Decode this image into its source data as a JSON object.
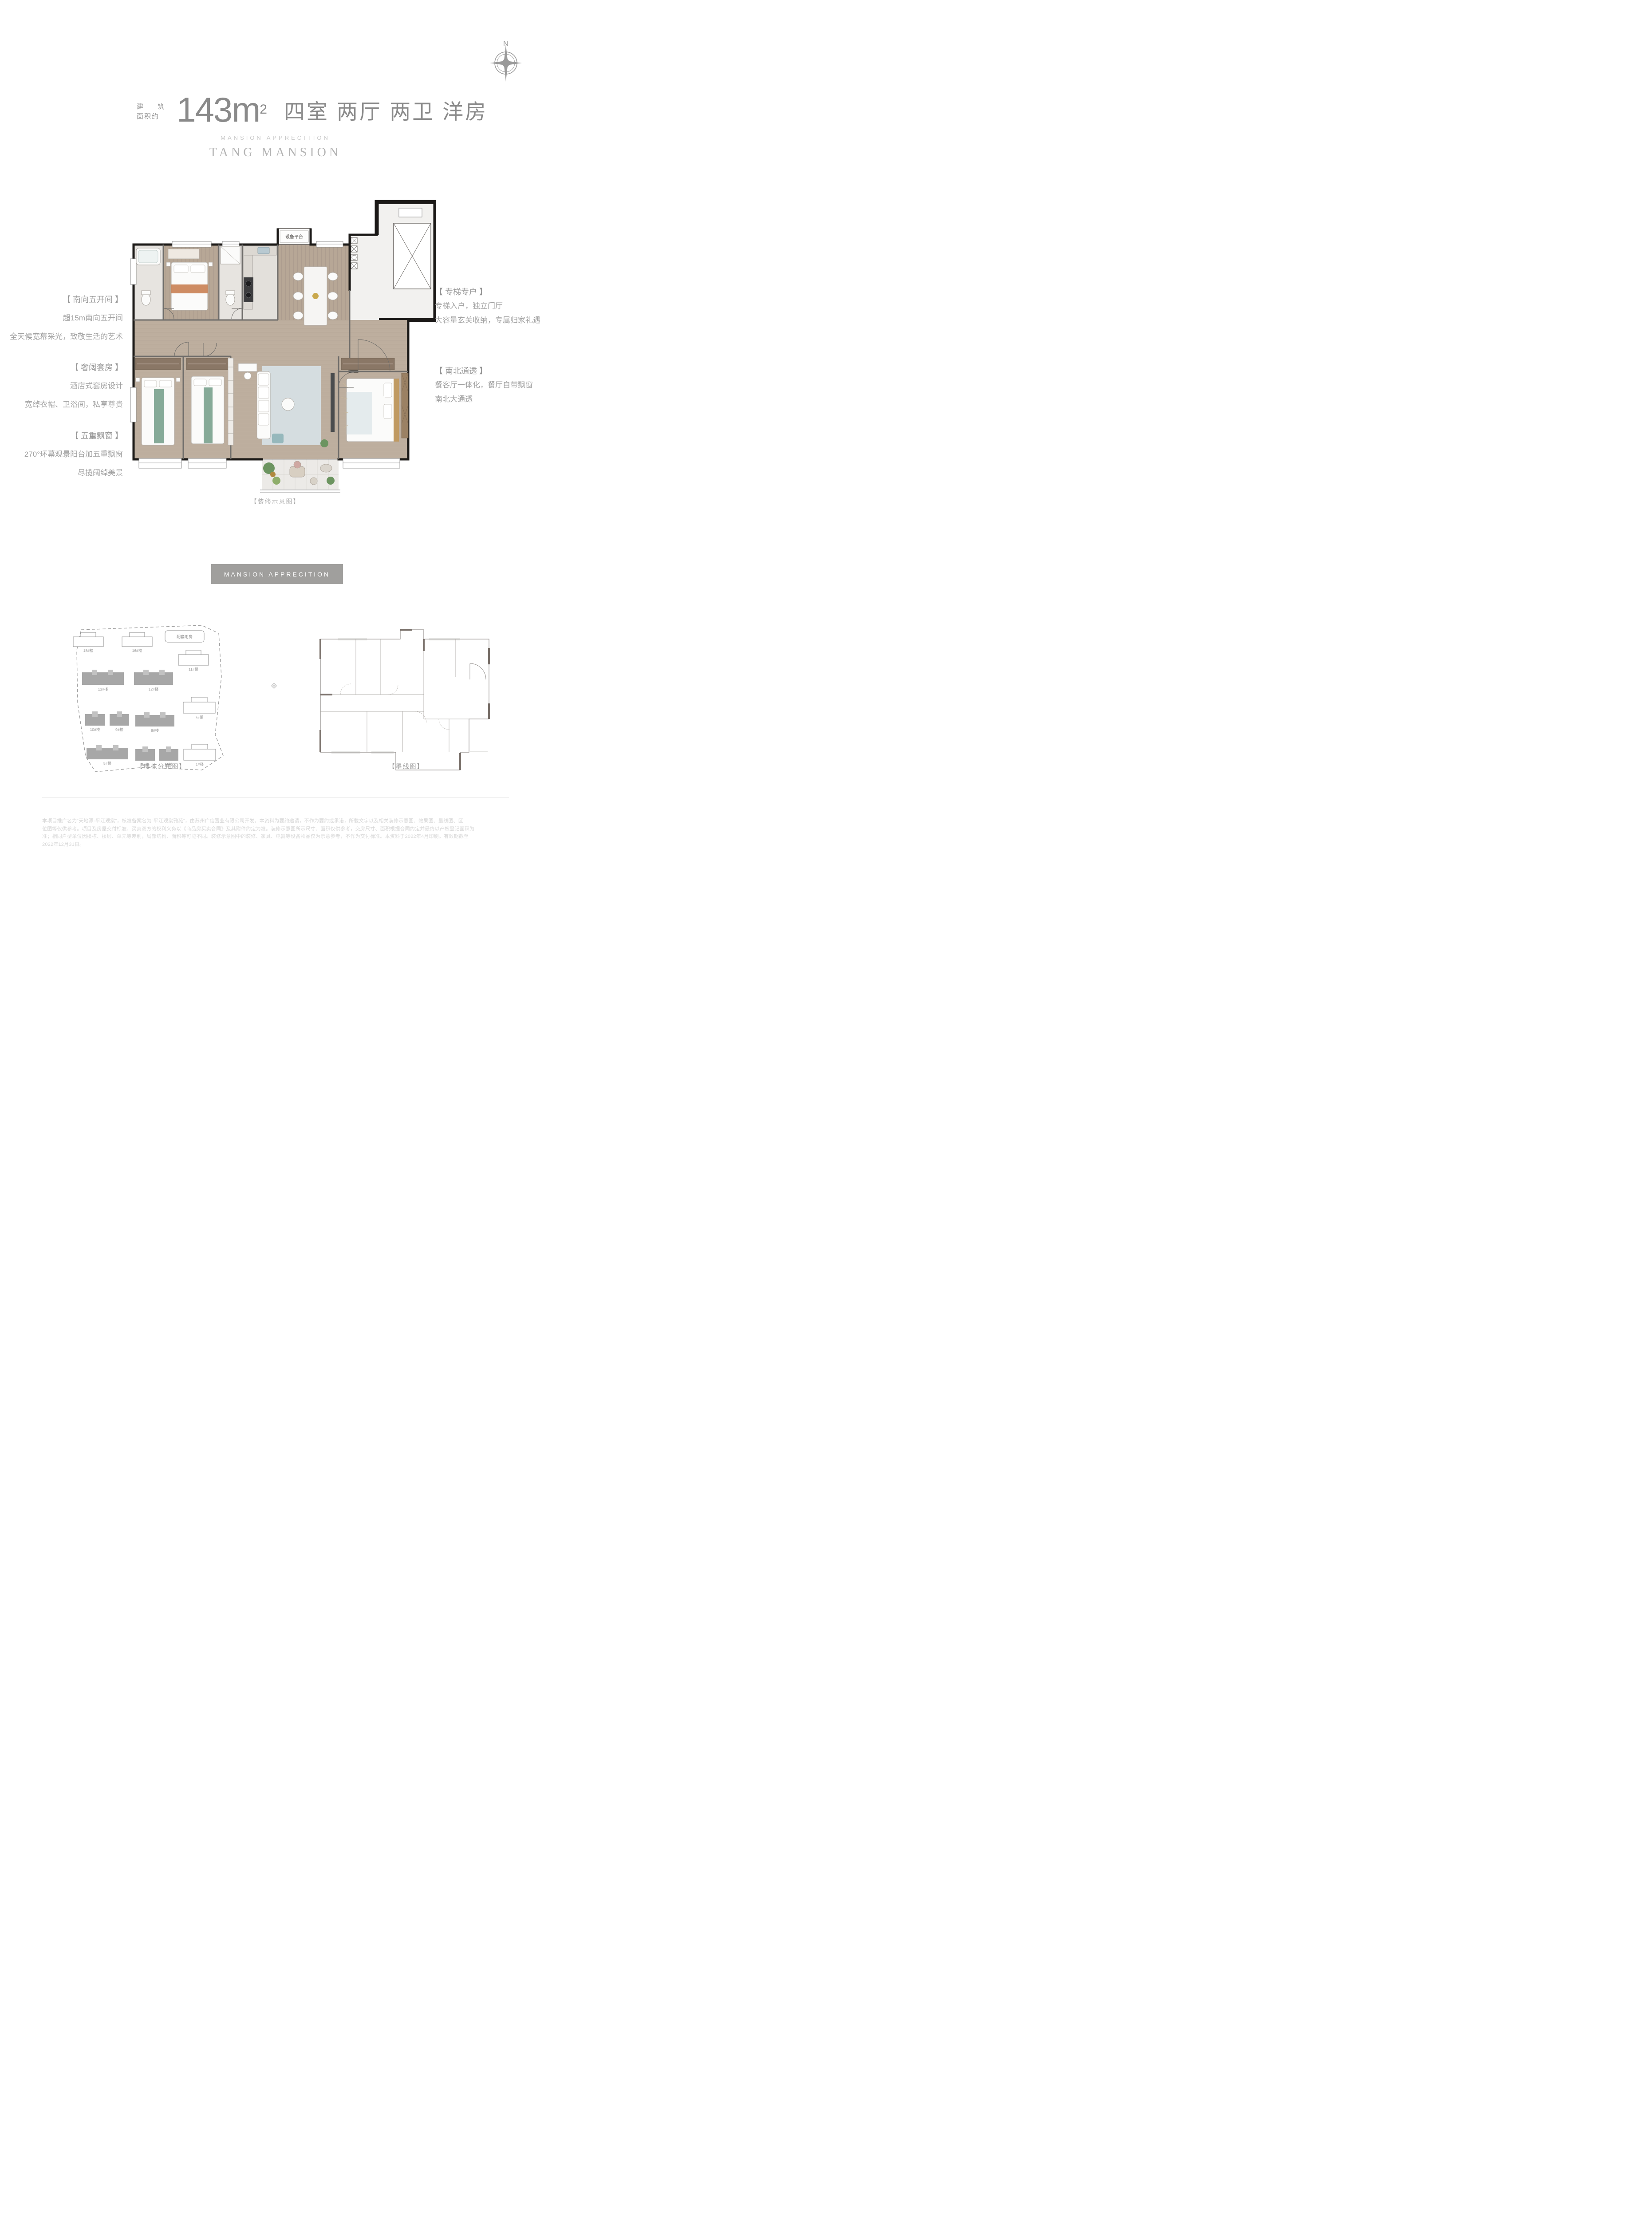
{
  "header": {
    "area_label_line1": "建 筑",
    "area_label_line2": "面积约",
    "area_number": "143m",
    "area_superscript": "2",
    "layout_title": "四室 两厅 两卫  洋房",
    "series_en": "MANSION APPRECITION",
    "brand_en": "TANG MANSION",
    "compass_north": "N"
  },
  "floorplan": {
    "equipment_platform_label": "设备平台",
    "caption": "【装修示意图】"
  },
  "features_left": [
    {
      "title": "【 南向五开间 】",
      "lines": [
        "超15m南向五开间",
        "全天候宽幕采光，致敬生活的艺术"
      ]
    },
    {
      "title": "【 奢阔套房 】",
      "lines": [
        "酒店式套房设计",
        "宽绰衣帽、卫浴间，私享尊贵"
      ]
    },
    {
      "title": "【 五重飘窗 】",
      "lines": [
        "270°环幕观景阳台加五重飘窗",
        "尽揽阔绰美景"
      ]
    }
  ],
  "features_right": [
    {
      "title": "【 专梯专户 】",
      "lines": [
        "专梯入户，独立门厅",
        "大容量玄关收纳，专属归家礼遇"
      ]
    },
    {
      "title": "【 南北通透 】",
      "lines": [
        "餐客厅一体化，餐厅自带飘窗",
        "南北大通透"
      ]
    }
  ],
  "section_divider": {
    "badge": "MANSION APPRECITION"
  },
  "site_plan": {
    "caption": "【楼栋分布图】",
    "amenity_label": "配套用房",
    "buildings": [
      {
        "label": "18#楼",
        "type": "outline"
      },
      {
        "label": "16#楼",
        "type": "outline"
      },
      {
        "label": "11#楼",
        "type": "outline"
      },
      {
        "label": "13#楼",
        "type": "filled"
      },
      {
        "label": "12#楼",
        "type": "filled"
      },
      {
        "label": "7#楼",
        "type": "outline"
      },
      {
        "label": "10#楼",
        "type": "filled"
      },
      {
        "label": "9#楼",
        "type": "filled"
      },
      {
        "label": "8#楼",
        "type": "filled"
      },
      {
        "label": "5#楼",
        "type": "filled"
      },
      {
        "label": "3#楼",
        "type": "filled"
      },
      {
        "label": "2#楼",
        "type": "filled"
      },
      {
        "label": "1#楼",
        "type": "outline"
      }
    ]
  },
  "ink_plan": {
    "caption": "【墨线图】"
  },
  "disclaimer": {
    "line1": "本项目推广名为“天地源·平江观棠”，核准备案名为“平江观棠雅苑”，由苏州广信置业有限公司开发。本资料为要约邀请，不作为要约或承诺，所载文字以及相关装修示意图、效果图、墨线图、区",
    "line2": "位图等仅供参考。项目及房屋交付标准、买卖双方的权利义务以《商品房买卖合同》及其附件约定为准。装修示意图所示尺寸、面积仅供参考，交房尺寸、面积根据合同约定并最终以产权登记面积为",
    "line3": "准；相同户型单位因楼栋、楼层、单元等差别，局部结构、面积等可能不同。装修示意图中的装修、家具、电器等设备物品仅为示意参考，不作为交付标准。本资料于2022年4月印刷。有效期截至",
    "line4": "2022年12月31日。"
  },
  "colors": {
    "title_gray": "#8a8a8a",
    "annotation_gray": "#a2a2a2",
    "badge_bg": "#a09f9d",
    "wall_black": "#1b1917",
    "wood_floor": "#b7a796",
    "tile": "#e7e4e0",
    "balcony_tile": "#eceae7",
    "accent_orange": "#c97f52",
    "accent_green": "#79a18d",
    "rug_blue": "#d5dde0",
    "plant_green": "#6c9460"
  }
}
